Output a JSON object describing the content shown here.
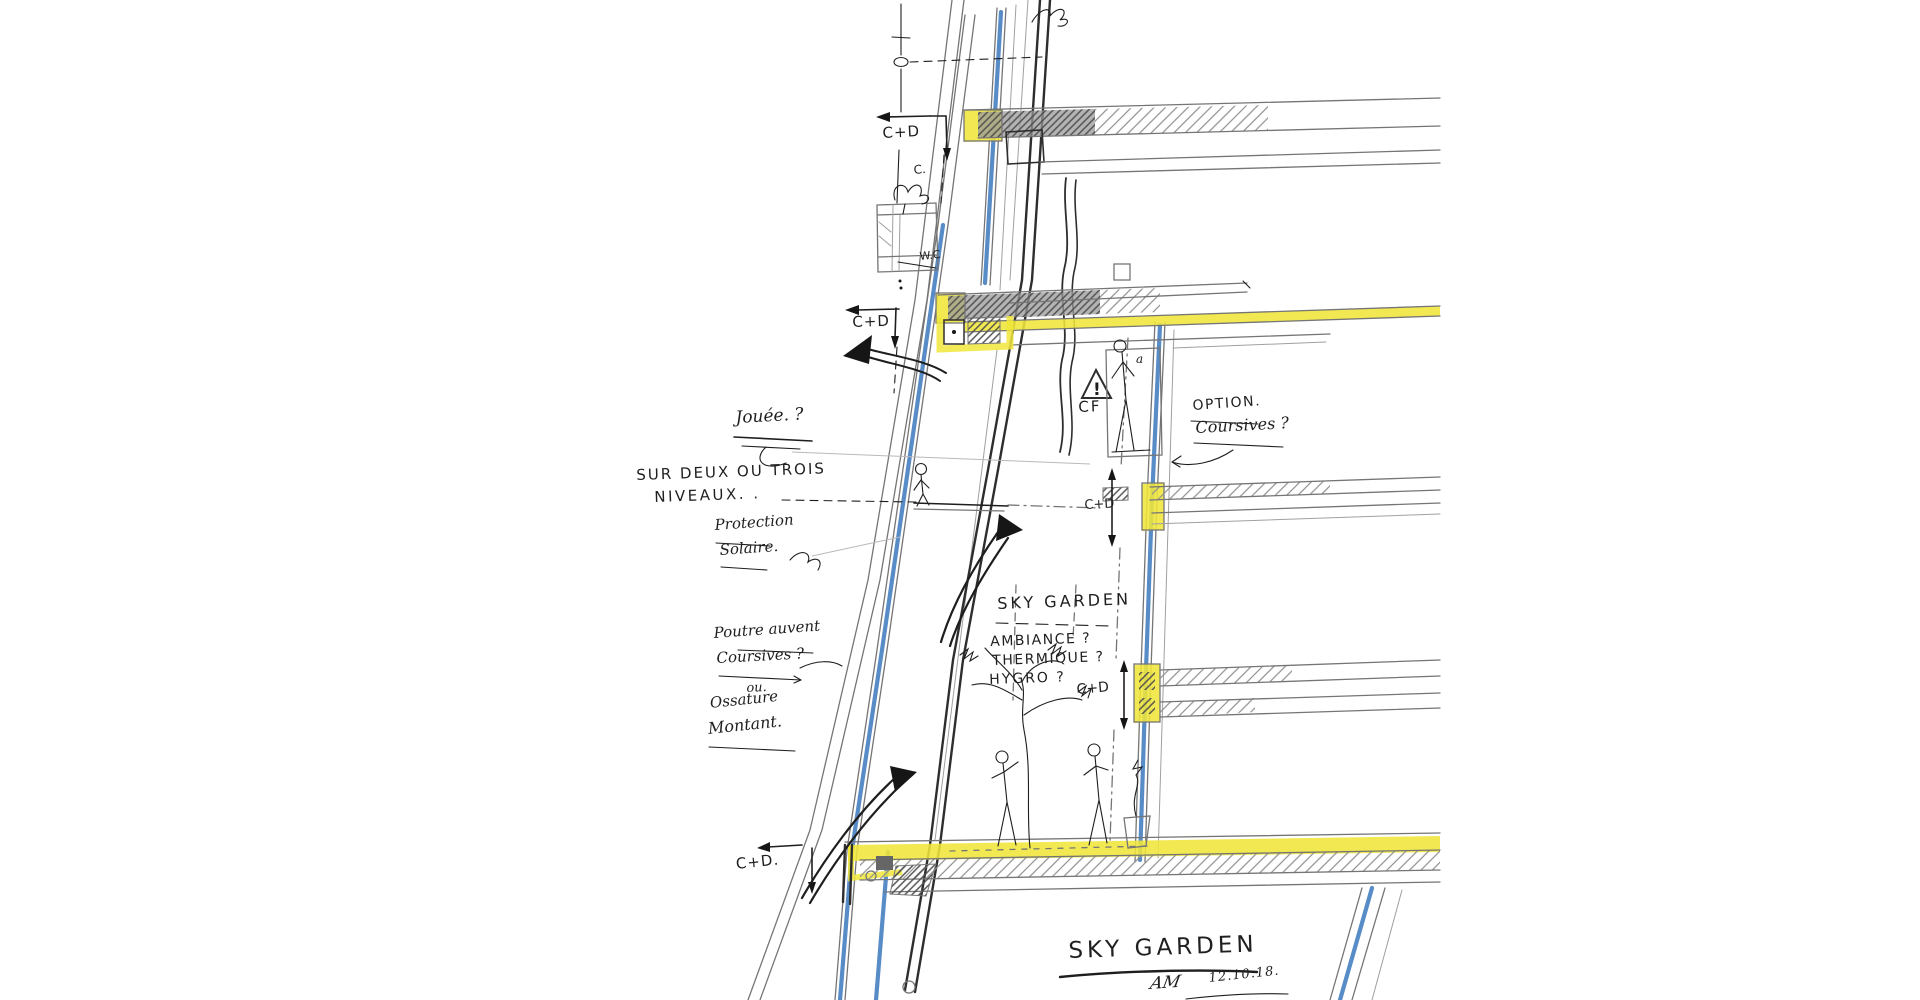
{
  "labels": {
    "cd_top": "C+D",
    "c_note": "C.",
    "wc_note": "W.C",
    "cd_mid": "C+D",
    "jouee": "Jouée. ?",
    "sur_deux": "SUR DEUX OU TROIS",
    "niveaux": "NIVEAUX. .",
    "protection": "Protection",
    "solaire": "Solaire.",
    "option": "OPTION.",
    "option_coursives": "Coursives ?",
    "cf_label": "CF",
    "cf_warning": "!",
    "a_note": "a",
    "sky_garden": "SKY GARDEN",
    "ambiance": "AMBIANCE ?",
    "thermique": "THERMIQUE ?",
    "hygro": "HYGRO ?",
    "poutre_auvent": "Poutre auvent",
    "coursives": "Coursives ?",
    "ou": "ou.",
    "ossature": "Ossature",
    "montant": "Montant.",
    "cd_right_upper": "C+D",
    "cd_right_lower": "C+D",
    "cd_bottom": "C+D."
  },
  "title_block": {
    "title": "SKY GARDEN",
    "monogram": "AM",
    "date": "12.10.18."
  },
  "colors": {
    "paper": "#ffffff",
    "pencil": "#757575",
    "pencil-light": "#a0a0a0",
    "ink": "#1e1e1e",
    "blue": "#4f86c4",
    "yellow": "#f0e63a",
    "slab": "#9a9a9a"
  }
}
